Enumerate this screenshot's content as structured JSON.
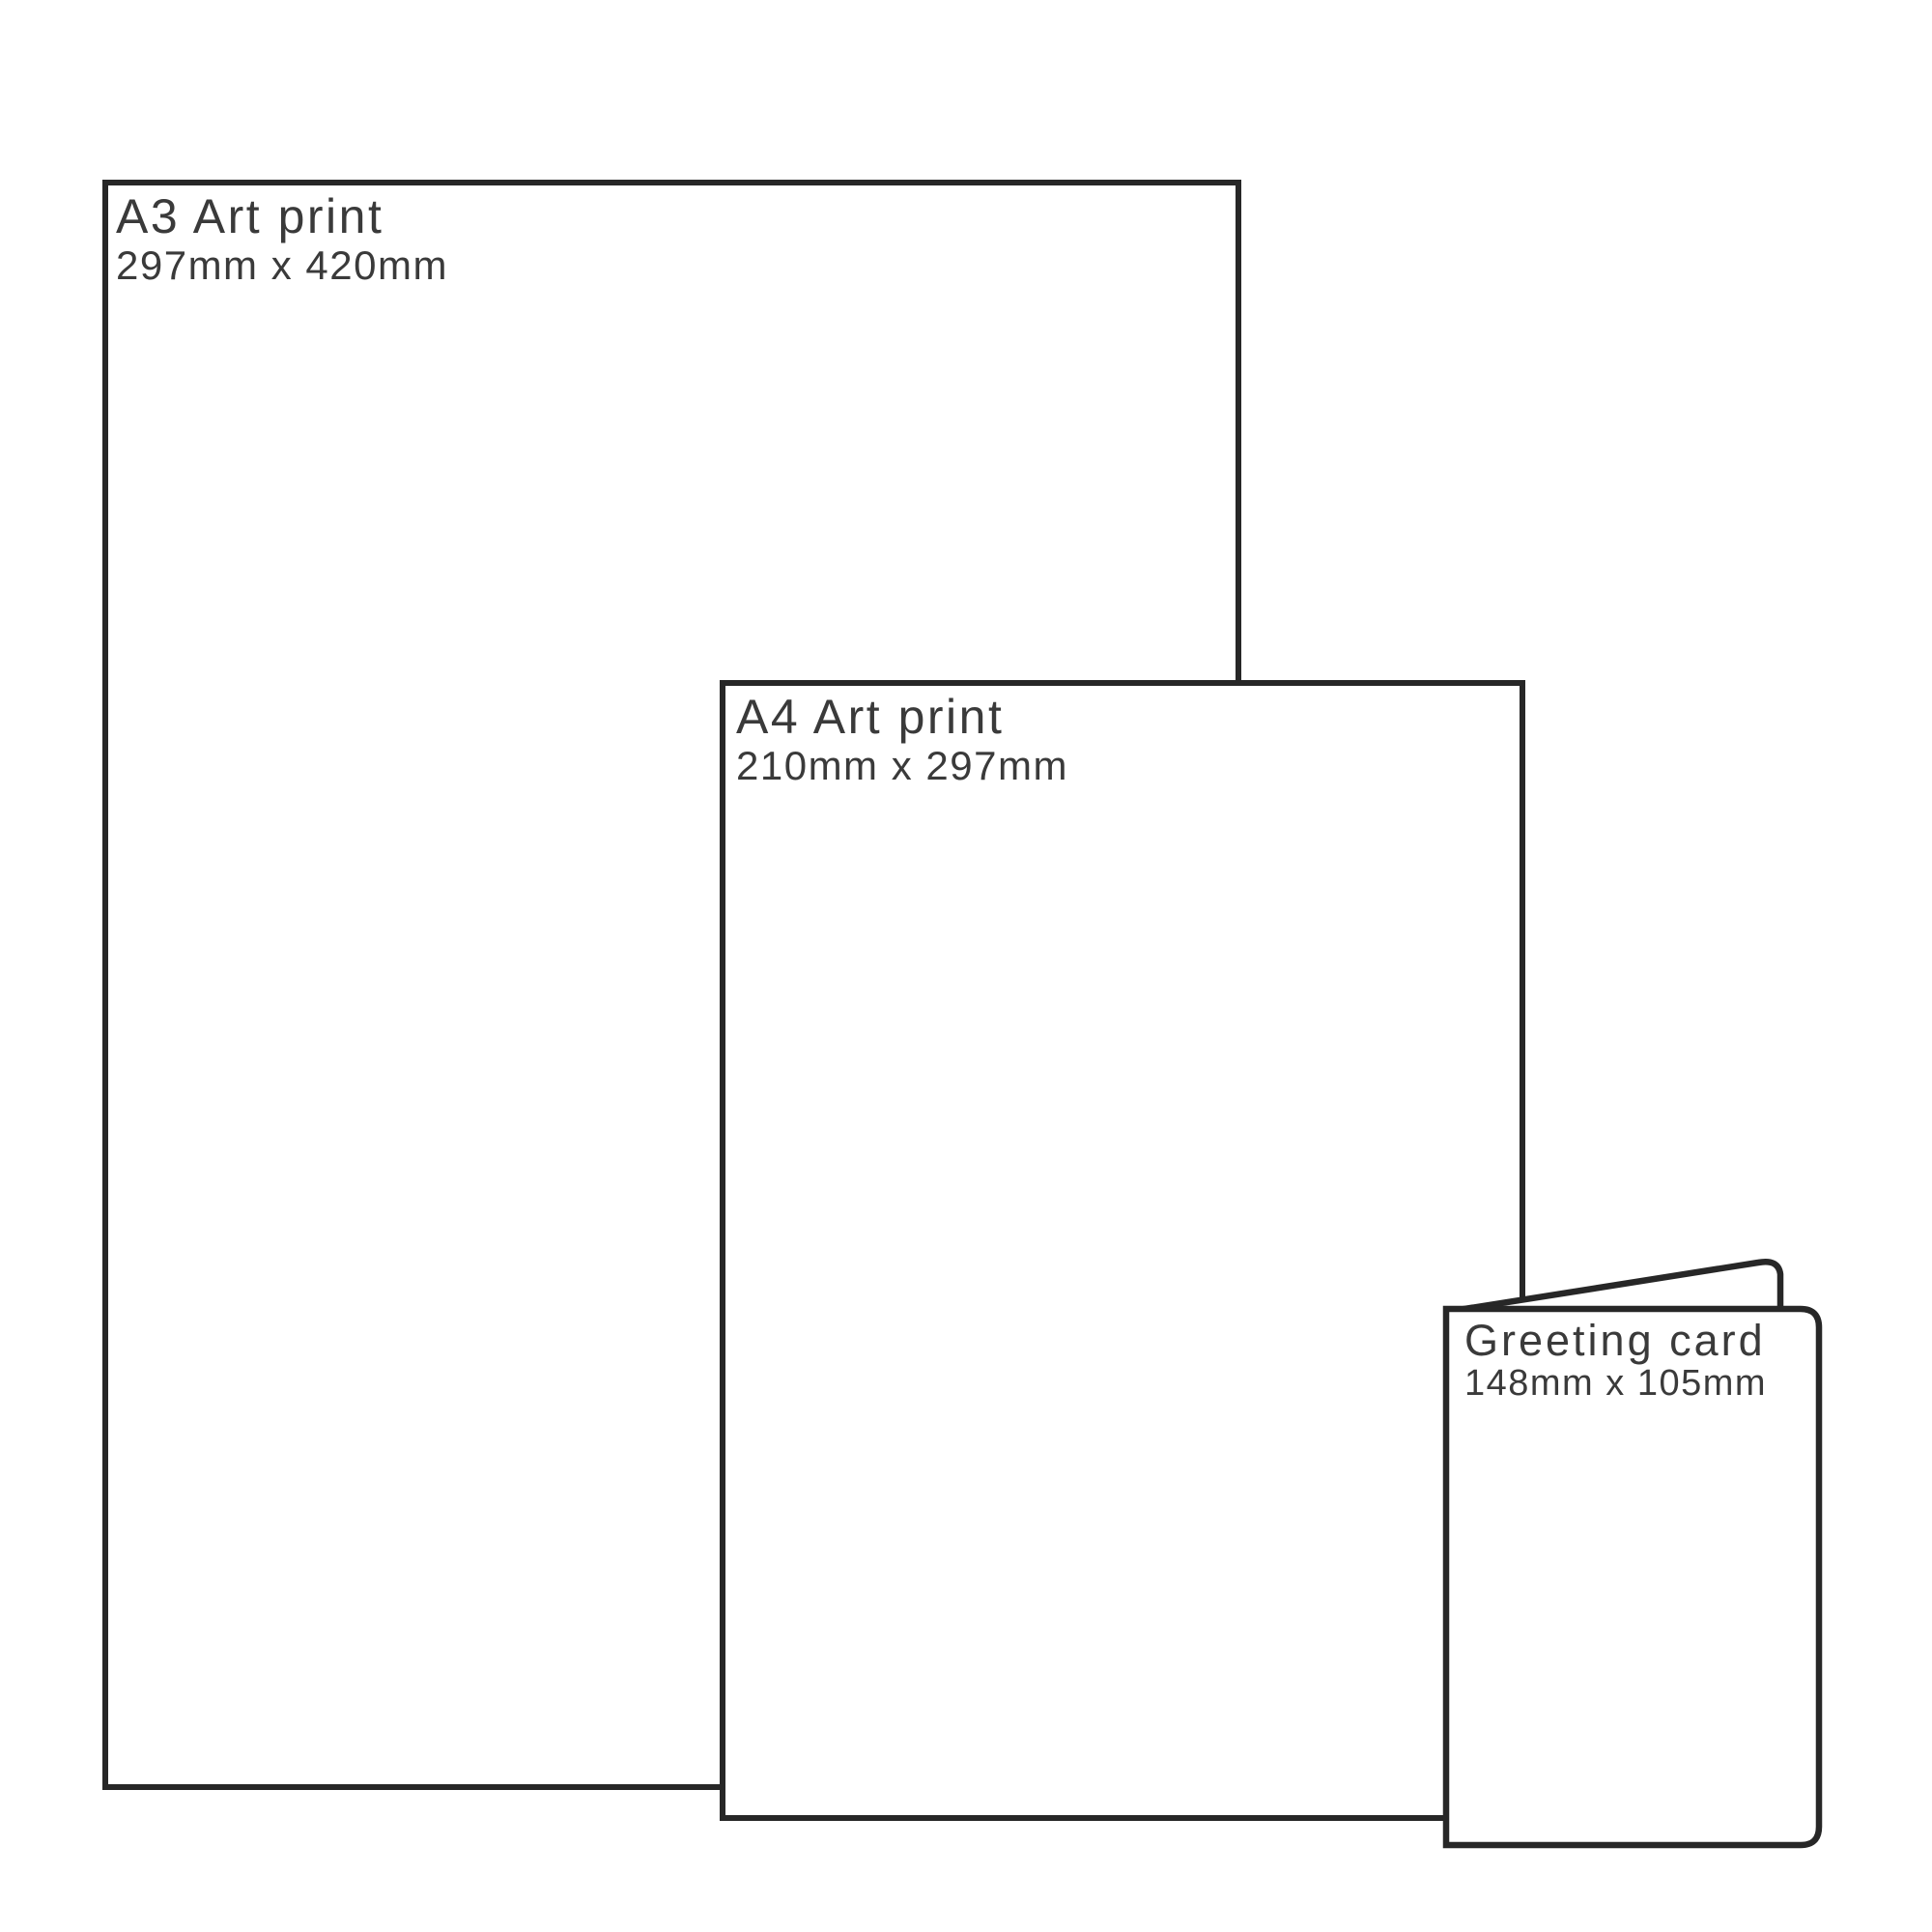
{
  "theme": {
    "ink_color": "#272727",
    "text_color": "#3a3a3a",
    "background_color": "#ffffff"
  },
  "items": [
    {
      "id": "a3-print",
      "title": "A3 Art print",
      "dimensions": "297mm x 420mm"
    },
    {
      "id": "a4-print",
      "title": "A4 Art print",
      "dimensions": "210mm x 297mm"
    },
    {
      "id": "greeting-card",
      "title": "Greeting card",
      "dimensions": "148mm x 105mm"
    }
  ]
}
